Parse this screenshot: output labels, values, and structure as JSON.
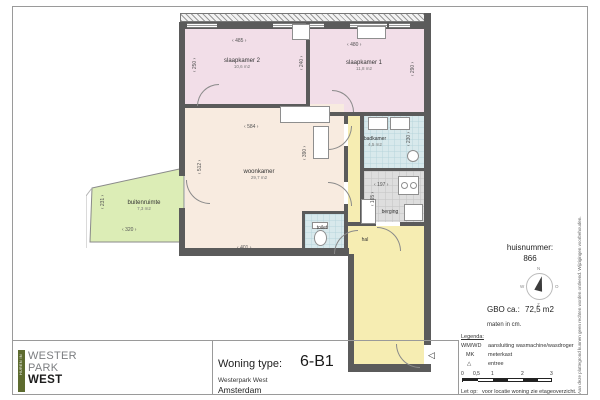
{
  "colors": {
    "bedroom_pink": "#f2dee8",
    "living_cream": "#f8ebe0",
    "outdoor_green": "#dcedb6",
    "wet_cyan": "#d8e9ec",
    "hall_yellow": "#f6edb2",
    "storage_gray": "#dedede",
    "wall_gray": "#5b5b5b",
    "logo_green": "#5d6b2f"
  },
  "plan": {
    "rooms": {
      "slaapkamer2": {
        "name": "slaapkamer 2",
        "area": "10,6 m2"
      },
      "slaapkamer1": {
        "name": "slaapkamer 1",
        "area": "11,8 m2"
      },
      "woonkamer": {
        "name": "woonkamer",
        "area": "29,7 m2"
      },
      "buitenruimte": {
        "name": "buitenruimte",
        "area": "7,3 m2"
      },
      "badkamer": {
        "name": "badkamer",
        "area": "4,5 m2"
      },
      "berging": {
        "name": "berging"
      },
      "toilet": {
        "name": "toilet"
      },
      "hal": {
        "name": "hal"
      }
    },
    "dims": {
      "slaapkamer2_breedte": "485",
      "slaapkamer1_breedte": "480",
      "slaapkamer2_diepte": "250",
      "tussen_diepte": "240",
      "slaapkamer1_diepte": "290",
      "woonkamer_breedte": "584",
      "woonkamer_diepte": "512",
      "keuken_diepte": "390",
      "woonkamer_breedte2": "401",
      "buitenruimte_diepte": "231",
      "buitenruimte_breedte": "320",
      "berging_breedte": "197",
      "berging_diepte": "165",
      "badkamer_diepte": "230"
    },
    "entree_marker": "◁"
  },
  "info_panel": {
    "huisnummer_label": "huisnummer:",
    "huisnummer_value": "866",
    "gbo_label": "GBO ca.:",
    "gbo_value": "72,5 m2",
    "units_note": "maten in cm.",
    "compass": {
      "north": "N",
      "east": "O",
      "south": "Z",
      "west": "W"
    }
  },
  "legend": {
    "title": "Legenda:",
    "item1_key": "WM/WD",
    "item1_label": "aansluiting wasmachine/wasdroger",
    "item2_key": "MK",
    "item2_label": "meterkast",
    "item3_icon": "△",
    "item3_label": "entree",
    "scale_labels": [
      "0",
      "0,5",
      "1",
      "2",
      "3"
    ],
    "note_label": "Let op:",
    "note_text": "voor locatie woning zie etageoverzicht."
  },
  "title_block": {
    "logo_band": "HUREN IN",
    "logo_line1": "WESTER",
    "logo_line2": "PARK",
    "logo_line3": "WEST",
    "woning_type_label": "Woning type:",
    "woning_type_value": "6-B1",
    "project_name": "Westerpark West",
    "city": "Amsterdam"
  },
  "page": {
    "disclaimer": "Aan deze plattegrond kunnen geen rechten worden ontleend. Wijzigingen voorbehouden."
  }
}
